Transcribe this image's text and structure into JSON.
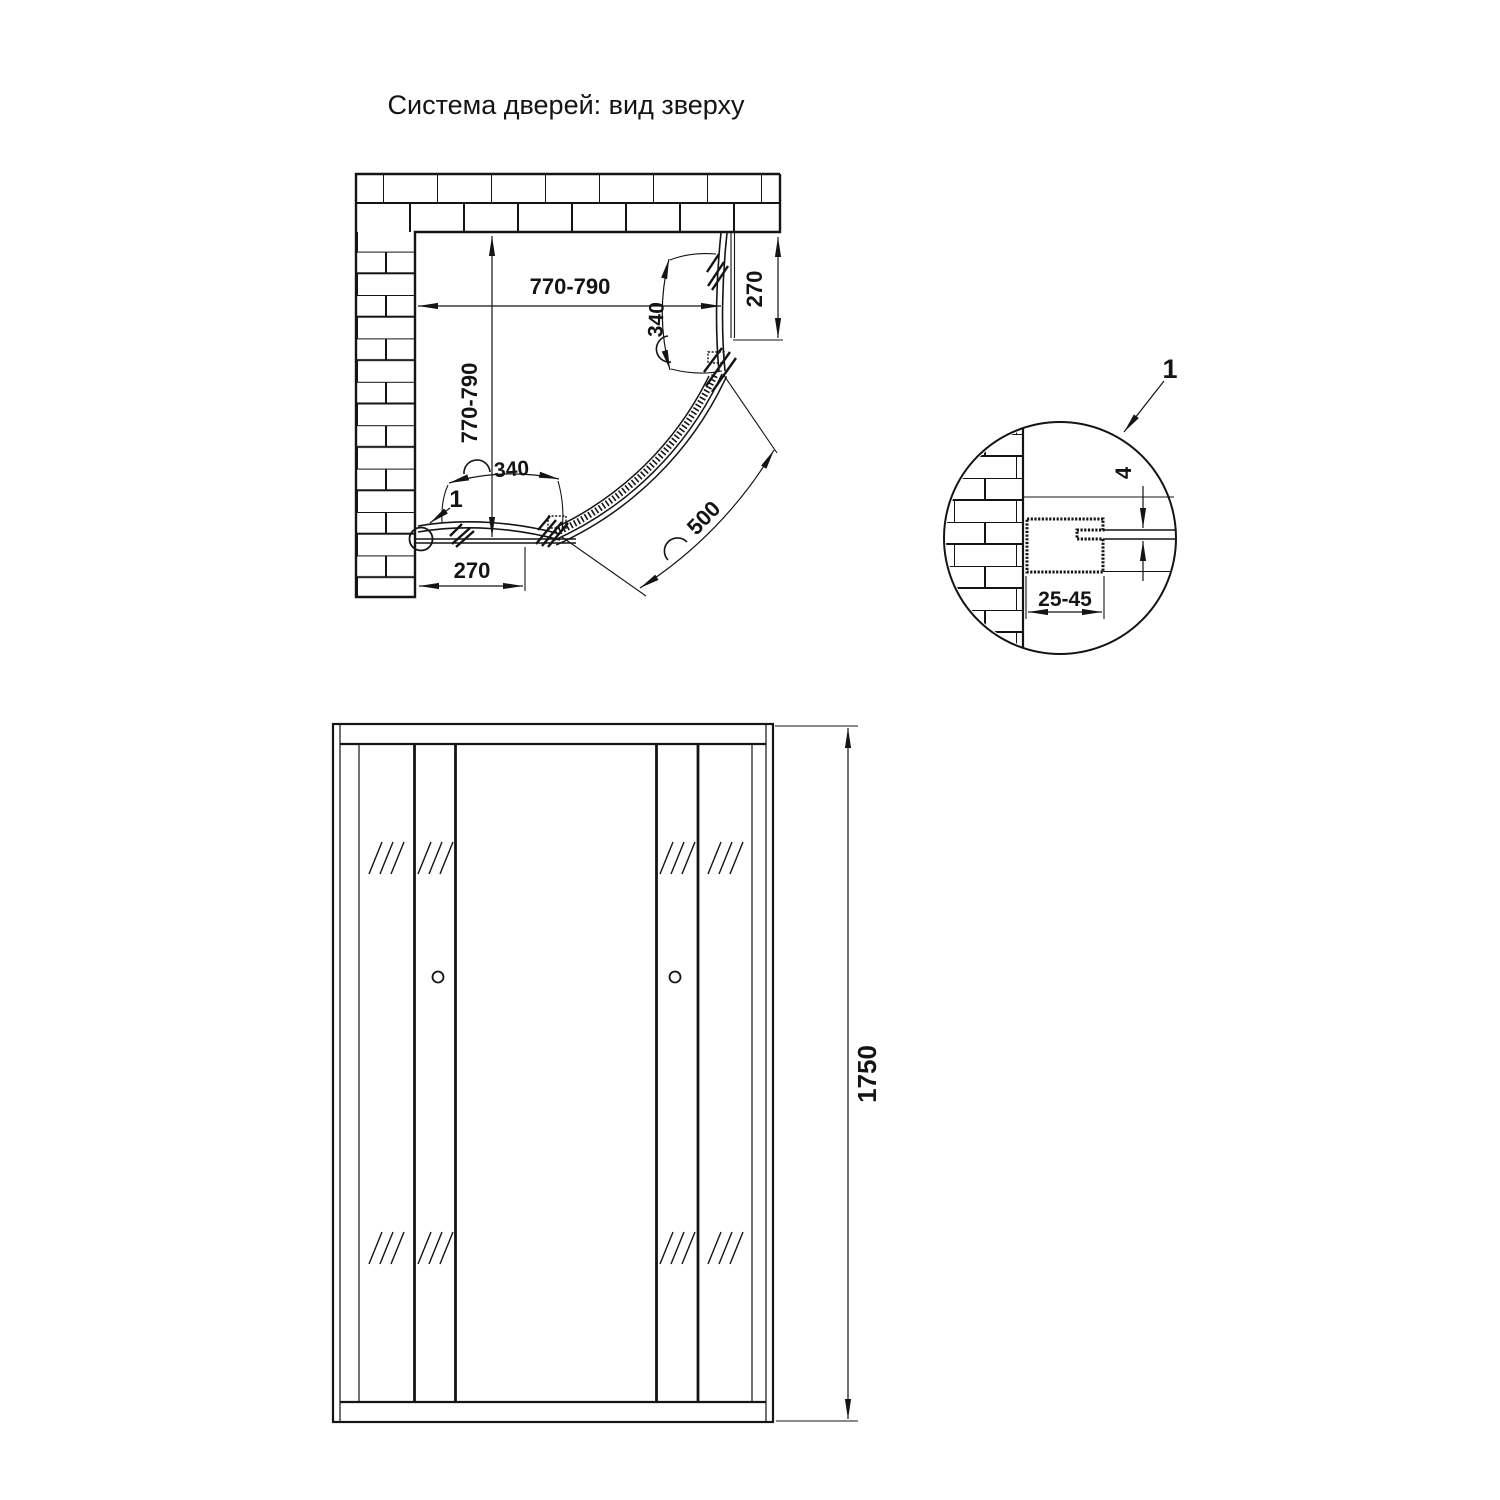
{
  "title": "Система дверей: вид зверху",
  "colors": {
    "line": "#141414",
    "background": "#ffffff"
  },
  "top_view": {
    "dimensions": {
      "width": "770-790",
      "depth": "770-790",
      "panel_arc_top": "340",
      "panel_arc_bottom": "340",
      "door_arc": "500",
      "offset_right": "270",
      "offset_bottom": "270"
    },
    "detail_marker": "1"
  },
  "detail_view": {
    "marker": "1",
    "glass_thickness": "4",
    "profile_adjustment_range": "25-45"
  },
  "front_view": {
    "height": "1750"
  }
}
